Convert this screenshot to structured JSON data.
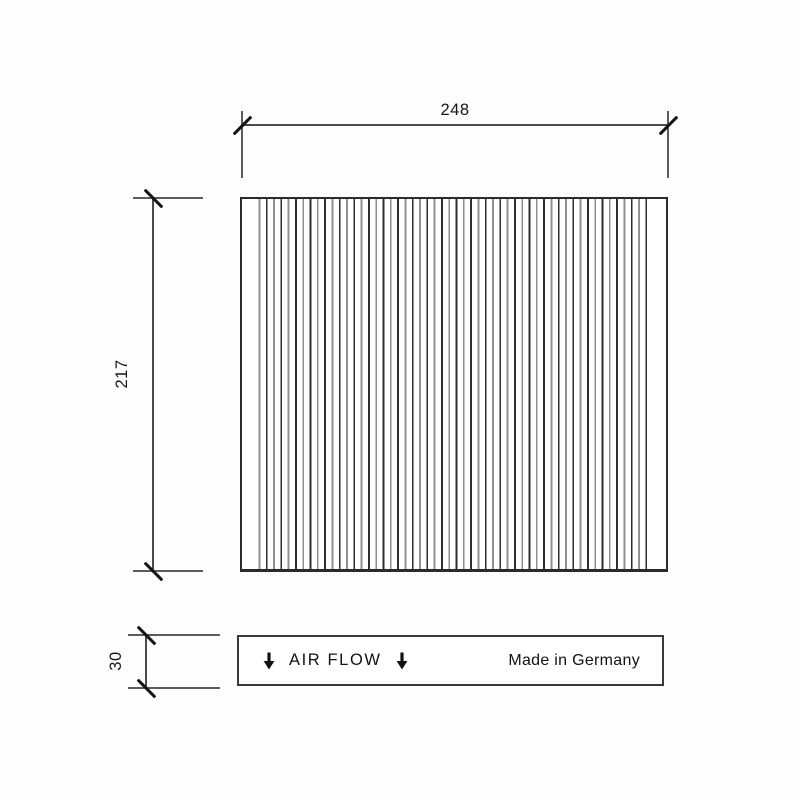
{
  "drawing": {
    "type": "technical-drawing-cabin-air-filter",
    "dimensions": {
      "width": "248",
      "height": "217",
      "depth": "30"
    },
    "label_box": {
      "air_flow_text": "AIR FLOW",
      "origin_text": "Made in Germany",
      "arrow_icon": "down-arrow"
    },
    "colors": {
      "background": "#fdfdfd",
      "line": "#4a4a4a",
      "tick": "#141414",
      "text": "#161616",
      "pleat_dark": "#2e2e2e",
      "pleat_gray": "#8f8f8f",
      "frame": "#2b2b2b"
    }
  }
}
